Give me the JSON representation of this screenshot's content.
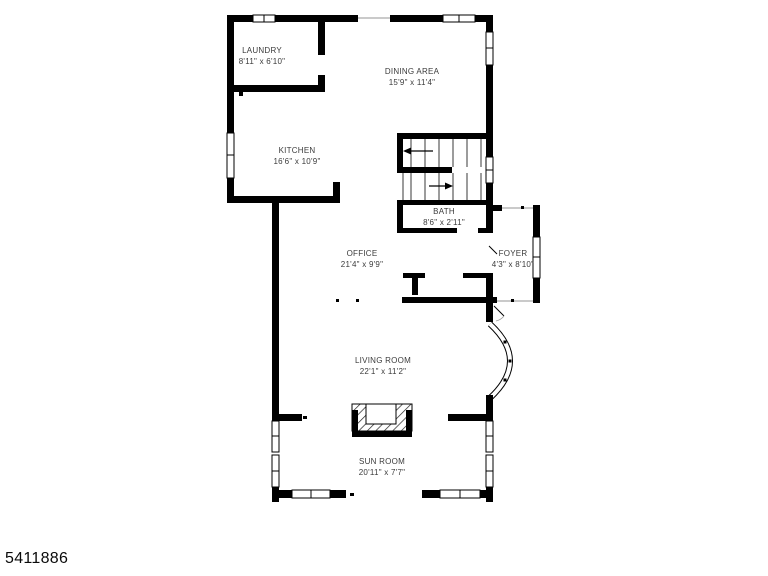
{
  "listing_id": "5411886",
  "plan": {
    "type": "floorplan",
    "rooms": [
      {
        "name": "LAUNDRY",
        "dims": "8'11\" x 6'10\""
      },
      {
        "name": "DINING AREA",
        "dims": "15'9\" x 11'4\""
      },
      {
        "name": "KITCHEN",
        "dims": "16'6\" x 10'9\""
      },
      {
        "name": "BATH",
        "dims": "8'6\" x 2'11\""
      },
      {
        "name": "OFFICE",
        "dims": "21'4\" x 9'9\""
      },
      {
        "name": "FOYER",
        "dims": "4'3\" x 8'10\""
      },
      {
        "name": "LIVING ROOM",
        "dims": "22'1\" x 11'2\""
      },
      {
        "name": "SUN ROOM",
        "dims": "20'11\" x 7'7\""
      }
    ],
    "features": [
      "staircase",
      "fireplace",
      "bay-window"
    ],
    "colors": {
      "wall": "#000000",
      "label_text": "#3b3b3b",
      "background": "#ffffff",
      "opening_line": "#b9b9b9"
    }
  }
}
